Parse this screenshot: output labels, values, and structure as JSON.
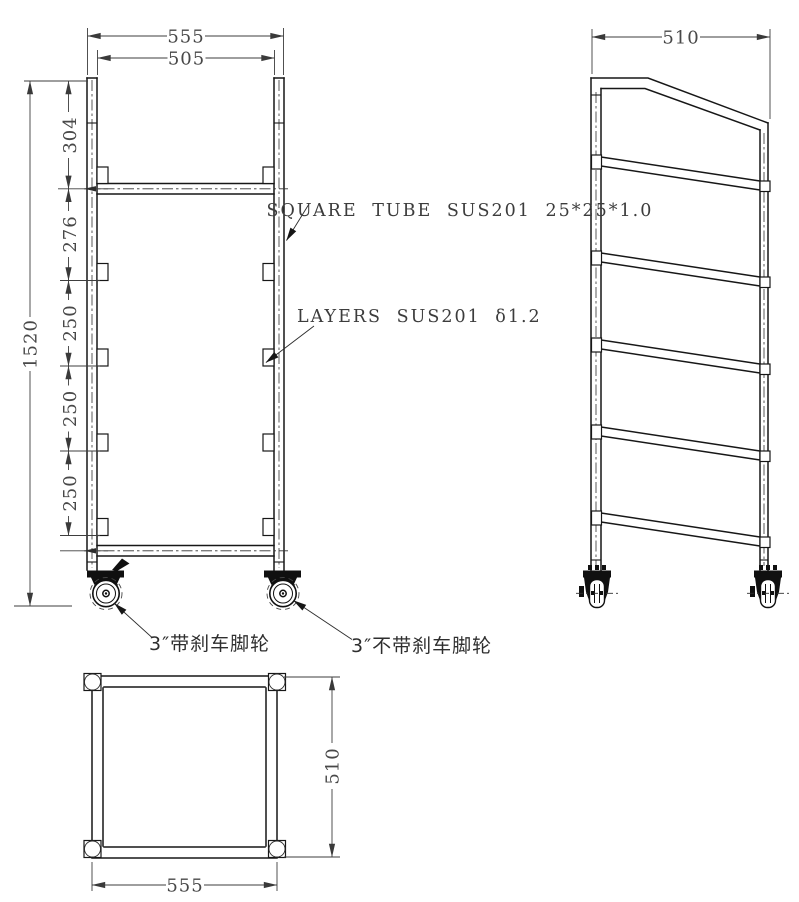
{
  "annotations": {
    "tube_spec": "SQUARE TUBE SUS201 25*25*1.0",
    "layer_spec": "LAYERS SUS201 δ1.2",
    "caster_with_brake": "3″带刹车脚轮",
    "caster_without_brake": "3″不带刹车脚轮"
  },
  "front_view": {
    "dim_width_outer": "555",
    "dim_width_inner": "505",
    "dim_height_overall": "1520",
    "dim_segments": [
      "304",
      "276",
      "250",
      "250",
      "250"
    ]
  },
  "side_view": {
    "dim_depth": "510"
  },
  "bottom_view": {
    "dim_depth": "510",
    "dim_width": "555"
  },
  "colors": {
    "line": "#171717",
    "dim": "#3e3e3e",
    "background": "#ffffff"
  }
}
